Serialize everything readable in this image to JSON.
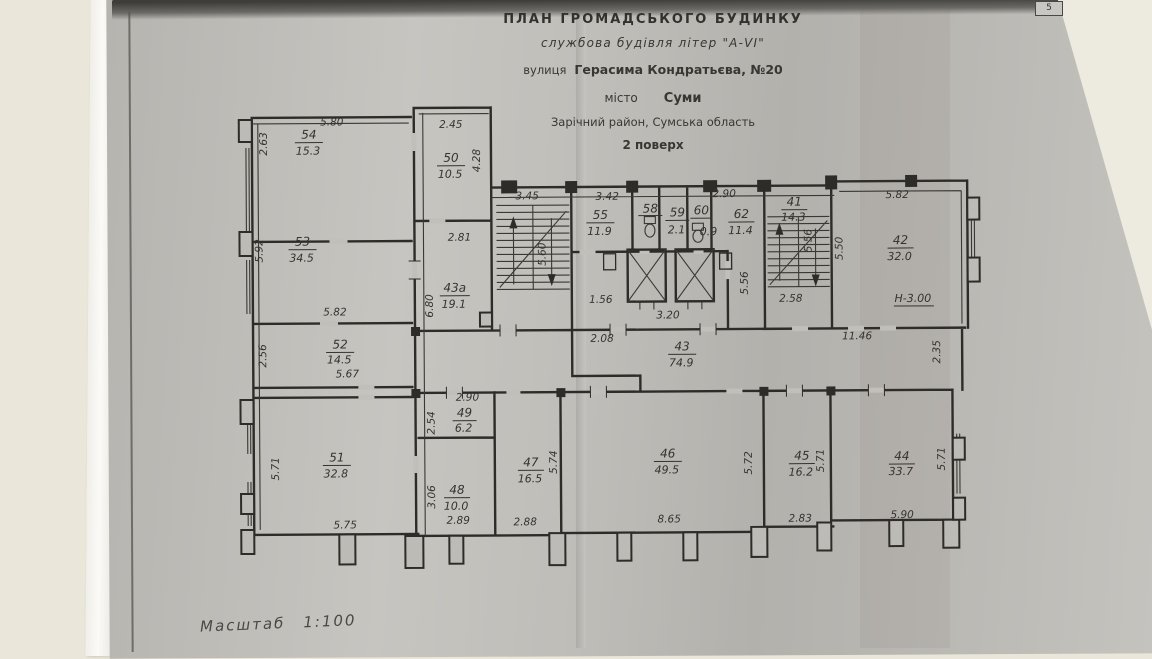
{
  "document": {
    "page_number": "5",
    "title_block": {
      "line1": "ПЛАН  ГРОМАДСЬКОГО  БУДИНКУ",
      "line2": "службова будівля літер \"А-VІ\"",
      "line3_prefix": "вулиця",
      "line3_value": "Герасима Кондратьєва, №20",
      "line4_prefix": "місто",
      "line4_value": "Суми",
      "line5": "Зарічний район, Сумська область",
      "line6": "2 поверх"
    },
    "scale": {
      "label": "Масштаб",
      "value": "1:100"
    },
    "floor_plan": {
      "height_note": "Н-3.00",
      "rooms": [
        {
          "n": "54",
          "a": "15.3"
        },
        {
          "n": "50",
          "a": "10.5"
        },
        {
          "n": "53",
          "a": "34.5"
        },
        {
          "n": "43а",
          "a": "19.1"
        },
        {
          "n": "52",
          "a": "14.5"
        },
        {
          "n": "51",
          "a": "32.8"
        },
        {
          "n": "55",
          "a": "11.9"
        },
        {
          "n": "58",
          "a": ""
        },
        {
          "n": "59",
          "a": "2.1"
        },
        {
          "n": "60",
          "a": "0.9"
        },
        {
          "n": "62",
          "a": "11.4"
        },
        {
          "n": "41",
          "a": "14.3"
        },
        {
          "n": "42",
          "a": "32.0"
        },
        {
          "n": "43",
          "a": "74.9"
        },
        {
          "n": "49",
          "a": "6.2"
        },
        {
          "n": "48",
          "a": "10.0"
        },
        {
          "n": "47",
          "a": "16.5"
        },
        {
          "n": "46",
          "a": "49.5"
        },
        {
          "n": "45",
          "a": "16.2"
        },
        {
          "n": "44",
          "a": "33.7"
        }
      ],
      "dims": [
        "5.80",
        "2.45",
        "2.81",
        "5.82",
        "5.67",
        "5.75",
        "3.45",
        "3.42",
        "2.90",
        "1.56",
        "3.20",
        "2.08",
        "2.58",
        "5.82",
        "11.46",
        "2.90",
        "2.89",
        "2.88",
        "8.65",
        "2.83",
        "5.90",
        "2.63",
        "4.28",
        "5.92",
        "6.80",
        "2.56",
        "5.71",
        "5.60",
        "5.56",
        "5.56",
        "5.50",
        "2.35",
        "2.54",
        "3.06",
        "5.74",
        "5.72",
        "5.71",
        "5.71"
      ]
    }
  },
  "colors": {
    "paper_gray": "#bdbbb6",
    "background_cream": "#eae6d9",
    "ink": "#2e2c28"
  }
}
